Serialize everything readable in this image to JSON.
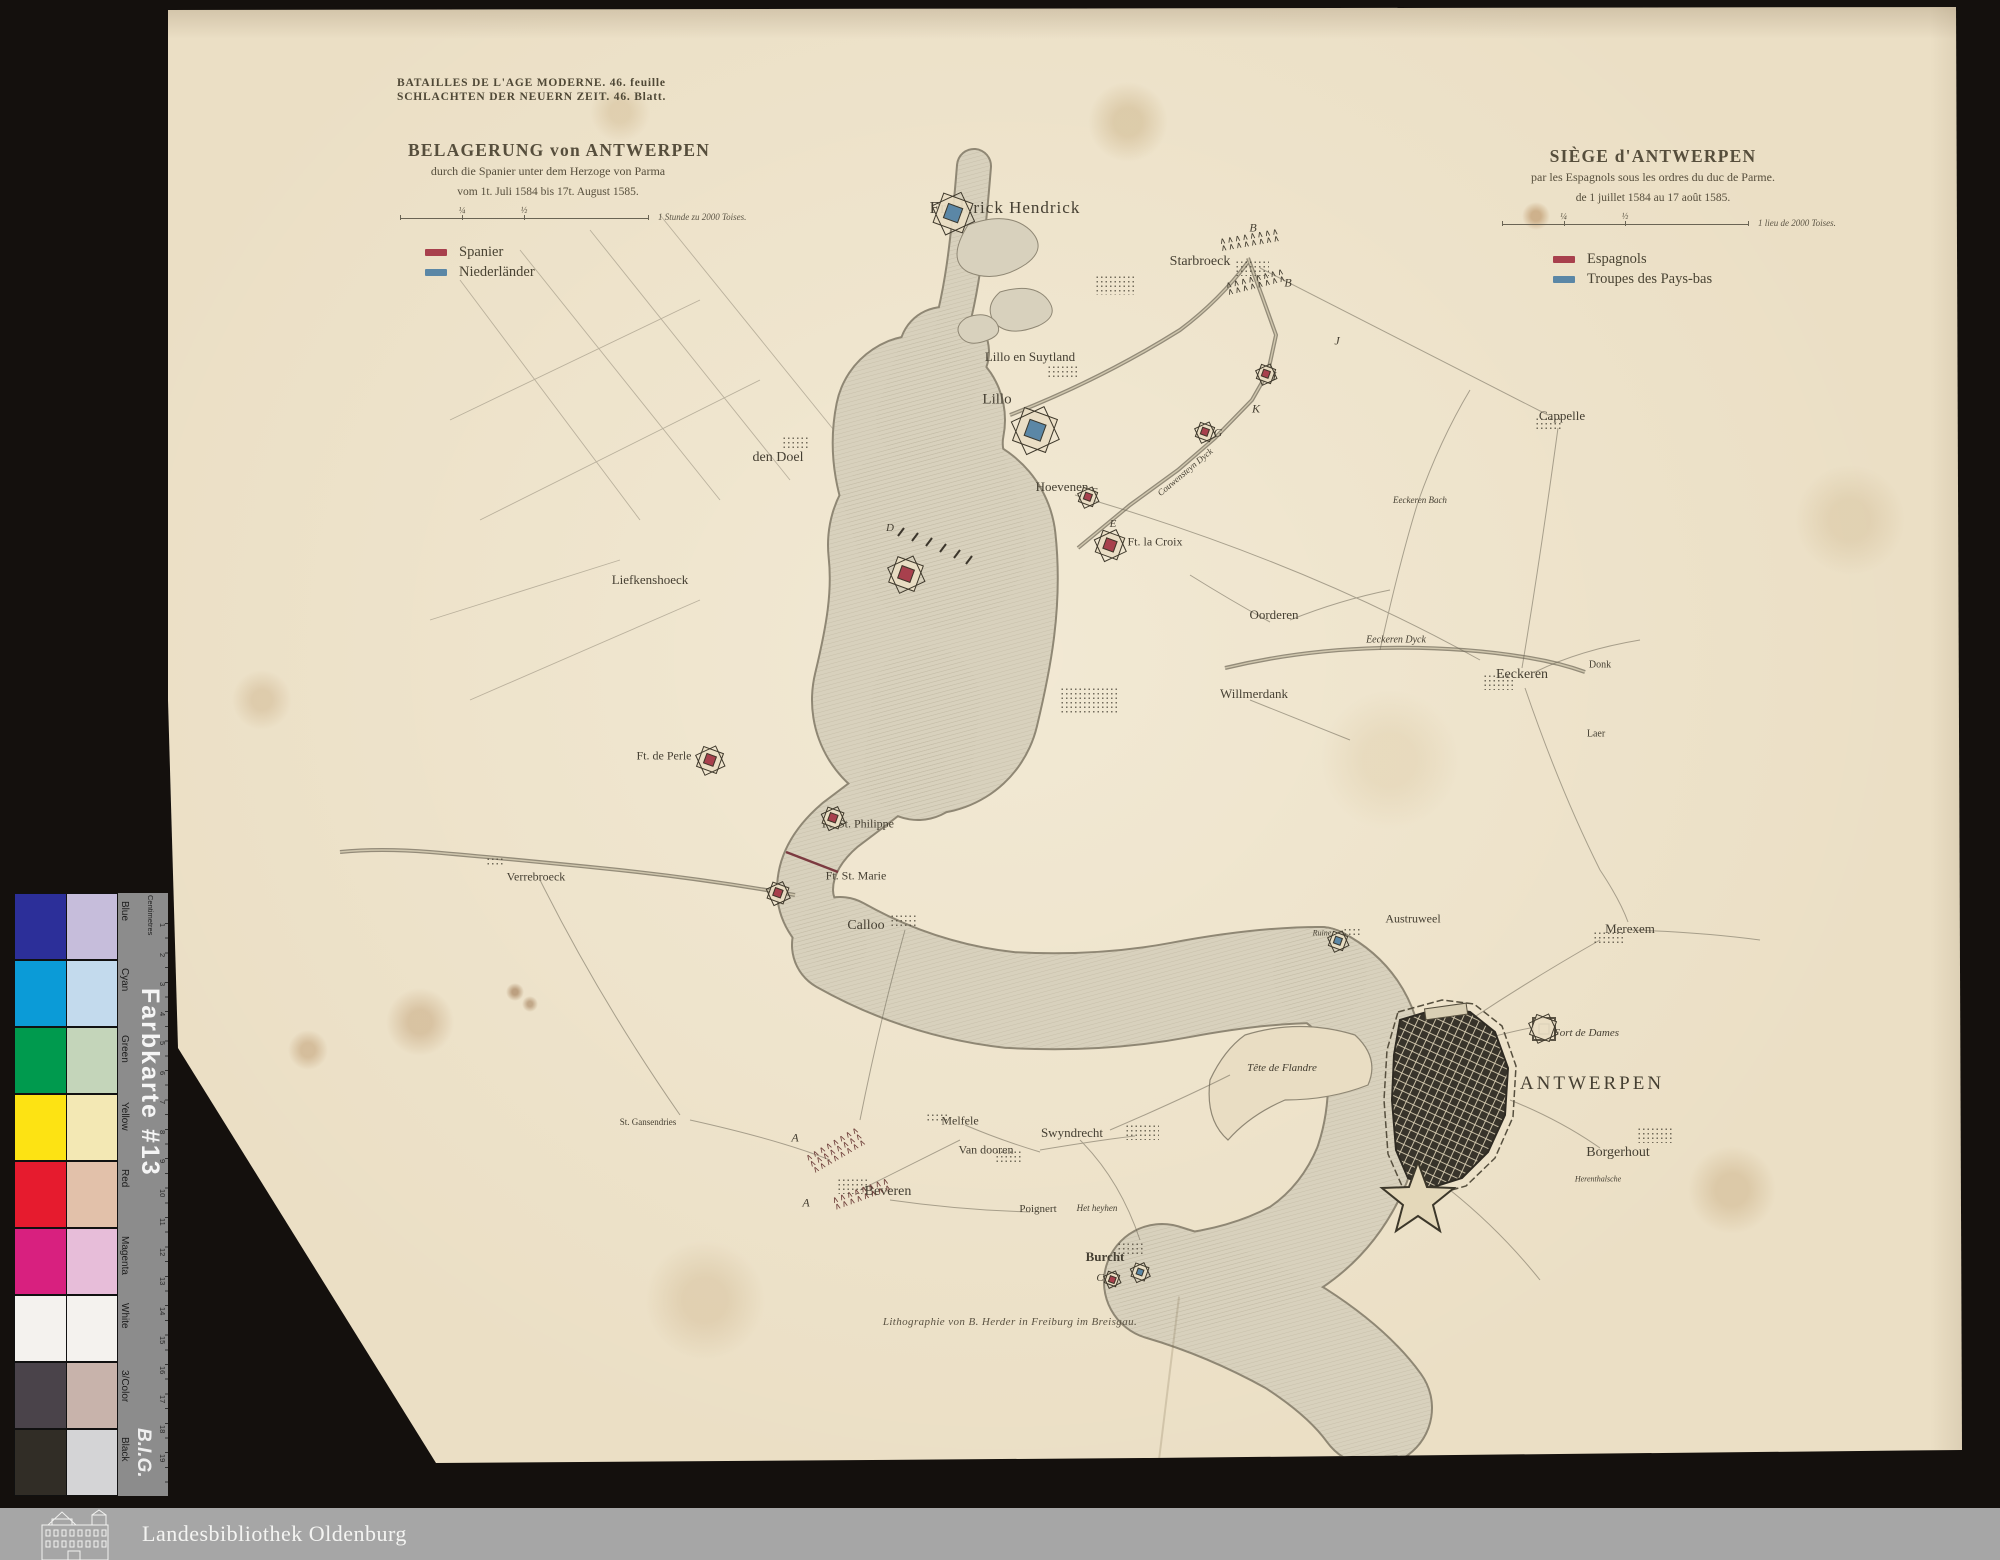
{
  "colors": {
    "spanish": "#a8404d",
    "dutch": "#5b87a6",
    "paper": "#ebdfc5",
    "ink": "#453f32"
  },
  "header": {
    "series_fr": "BATAILLES DE L'AGE MODERNE. 46. feuille",
    "series_de": "SCHLACHTEN DER NEUERN ZEIT. 46. Blatt.",
    "title_de": {
      "line1": "BELAGERUNG von ANTWERPEN",
      "line2": "durch die Spanier unter dem Herzoge von Parma",
      "line3": "vom 1t. Juli 1584 bis 17t. August 1585."
    },
    "title_fr": {
      "line1": "SIÈGE d'ANTWERPEN",
      "line2": "par les Espagnols sous les ordres du duc de Parme.",
      "line3": "de 1 juillet 1584 au 17 août 1585."
    },
    "scale_de": {
      "quarter": "¼",
      "half": "½",
      "label": "1 Stunde zu 2000 Toises."
    },
    "scale_fr": {
      "quarter": "¼",
      "half": "½",
      "label": "1 lieu de 2000 Toises."
    }
  },
  "legend_de": {
    "items": [
      {
        "label": "Spanier"
      },
      {
        "label": "Niederländer"
      }
    ]
  },
  "legend_fr": {
    "items": [
      {
        "label": "Espagnols"
      },
      {
        "label": "Troupes des Pays-bas"
      }
    ]
  },
  "map": {
    "imprint": "Lithographie von B. Herder in Freiburg im Breisgau.",
    "labels": [
      {
        "t": "Frederick Hendrick",
        "x": 1005,
        "y": 208,
        "s": 17,
        "ls": 1
      },
      {
        "t": "Starbroeck",
        "x": 1200,
        "y": 262,
        "s": 14
      },
      {
        "t": "Lillo en Suytland",
        "x": 1030,
        "y": 357,
        "s": 13
      },
      {
        "t": "Lillo",
        "x": 997,
        "y": 400,
        "s": 15
      },
      {
        "t": "Cappelle",
        "x": 1562,
        "y": 416,
        "s": 13
      },
      {
        "t": "den Doel",
        "x": 778,
        "y": 458,
        "s": 14
      },
      {
        "t": "Hoevenen",
        "x": 1062,
        "y": 487,
        "s": 13
      },
      {
        "t": "Ft. la Croix",
        "x": 1155,
        "y": 542,
        "s": 12
      },
      {
        "t": "Liefkenshoeck",
        "x": 650,
        "y": 580,
        "s": 13
      },
      {
        "t": "Couwensteyn Dyck",
        "x": 1185,
        "y": 472,
        "s": 9,
        "i": 1,
        "r": -40
      },
      {
        "t": "Eeckeren Bach",
        "x": 1420,
        "y": 500,
        "s": 9,
        "i": 1
      },
      {
        "t": "Oorderen",
        "x": 1274,
        "y": 615,
        "s": 13
      },
      {
        "t": "Eeckeren Dyck",
        "x": 1396,
        "y": 640,
        "s": 10,
        "i": 1
      },
      {
        "t": "Eeckeren",
        "x": 1522,
        "y": 675,
        "s": 14
      },
      {
        "t": "Donk",
        "x": 1600,
        "y": 665,
        "s": 10
      },
      {
        "t": "Willmerdank",
        "x": 1254,
        "y": 694,
        "s": 13
      },
      {
        "t": "Laer",
        "x": 1596,
        "y": 734,
        "s": 10
      },
      {
        "t": "Ft. de Perle",
        "x": 664,
        "y": 756,
        "s": 12
      },
      {
        "t": "Ft. St. Philippe",
        "x": 858,
        "y": 824,
        "s": 12
      },
      {
        "t": "Verrebroeck",
        "x": 536,
        "y": 877,
        "s": 12
      },
      {
        "t": "Ft. St. Marie",
        "x": 856,
        "y": 876,
        "s": 12
      },
      {
        "t": "Calloo",
        "x": 866,
        "y": 926,
        "s": 14
      },
      {
        "t": "Austruweel",
        "x": 1413,
        "y": 919,
        "s": 12
      },
      {
        "t": "Ruine",
        "x": 1322,
        "y": 933,
        "s": 8,
        "i": 1
      },
      {
        "t": "Merexem",
        "x": 1630,
        "y": 929,
        "s": 13
      },
      {
        "t": "Fort de Dames",
        "x": 1586,
        "y": 1033,
        "s": 11,
        "i": 1
      },
      {
        "t": "ANTWERPEN",
        "x": 1592,
        "y": 1084,
        "s": 19,
        "ls": 3
      },
      {
        "t": "Tête de Flandre",
        "x": 1282,
        "y": 1068,
        "s": 11,
        "i": 1
      },
      {
        "t": "Borgerhout",
        "x": 1618,
        "y": 1153,
        "s": 14
      },
      {
        "t": "Herenthalsche",
        "x": 1598,
        "y": 1179,
        "s": 8,
        "i": 1
      },
      {
        "t": "St. Gansendries",
        "x": 648,
        "y": 1122,
        "s": 9
      },
      {
        "t": "Melfele",
        "x": 960,
        "y": 1121,
        "s": 12
      },
      {
        "t": "Swyndrecht",
        "x": 1072,
        "y": 1133,
        "s": 13
      },
      {
        "t": "Van dooren",
        "x": 986,
        "y": 1150,
        "s": 12
      },
      {
        "t": "Beveren",
        "x": 888,
        "y": 1192,
        "s": 14
      },
      {
        "t": "Poignert",
        "x": 1038,
        "y": 1209,
        "s": 11
      },
      {
        "t": "Het heyhen",
        "x": 1097,
        "y": 1208,
        "s": 9,
        "i": 1
      },
      {
        "t": "Burcht",
        "x": 1105,
        "y": 1257,
        "s": 13,
        "b": 1
      },
      {
        "t": "B",
        "x": 1253,
        "y": 228,
        "s": 12,
        "i": 1
      },
      {
        "t": "B",
        "x": 1288,
        "y": 283,
        "s": 12,
        "i": 1
      },
      {
        "t": "J",
        "x": 1337,
        "y": 341,
        "s": 12,
        "i": 1
      },
      {
        "t": "H",
        "x": 1272,
        "y": 376,
        "s": 12,
        "i": 1
      },
      {
        "t": "K",
        "x": 1256,
        "y": 409,
        "s": 12,
        "i": 1
      },
      {
        "t": "G",
        "x": 1218,
        "y": 433,
        "s": 12,
        "i": 1
      },
      {
        "t": "F",
        "x": 1094,
        "y": 492,
        "s": 11,
        "i": 1
      },
      {
        "t": "E",
        "x": 1113,
        "y": 524,
        "s": 11,
        "i": 1
      },
      {
        "t": "D",
        "x": 890,
        "y": 528,
        "s": 11,
        "i": 1
      },
      {
        "t": "A",
        "x": 795,
        "y": 1138,
        "s": 12,
        "i": 1
      },
      {
        "t": "A",
        "x": 806,
        "y": 1203,
        "s": 12,
        "i": 1
      },
      {
        "t": "C",
        "x": 1100,
        "y": 1278,
        "s": 11,
        "i": 1
      }
    ],
    "forts": [
      {
        "x": 953,
        "y": 213,
        "c": "blue",
        "s": 30
      },
      {
        "x": 1035,
        "y": 430,
        "c": "blue",
        "s": 34
      },
      {
        "x": 906,
        "y": 574,
        "c": "red",
        "s": 26
      },
      {
        "x": 710,
        "y": 760,
        "c": "red",
        "s": 20
      },
      {
        "x": 1110,
        "y": 545,
        "c": "red",
        "s": 22
      },
      {
        "x": 1088,
        "y": 497,
        "c": "red",
        "s": 14
      },
      {
        "x": 1205,
        "y": 432,
        "c": "red",
        "s": 14
      },
      {
        "x": 1266,
        "y": 374,
        "c": "red",
        "s": 14
      },
      {
        "x": 833,
        "y": 818,
        "c": "red",
        "s": 16
      },
      {
        "x": 778,
        "y": 893,
        "c": "red",
        "s": 16
      },
      {
        "x": 1338,
        "y": 941,
        "c": "blue",
        "s": 14
      },
      {
        "x": 1112,
        "y": 1279,
        "c": "red",
        "s": 11
      },
      {
        "x": 1140,
        "y": 1272,
        "c": "blue",
        "s": 13
      },
      {
        "x": 1543,
        "y": 1028,
        "c": "none",
        "s": 20
      }
    ],
    "camps": [
      {
        "x": 1250,
        "y": 240,
        "rot": -10,
        "rows": 2,
        "col": "#433d30"
      },
      {
        "x": 1256,
        "y": 282,
        "rot": -14,
        "rows": 2,
        "col": "#433d30"
      },
      {
        "x": 836,
        "y": 1150,
        "rot": -30,
        "rows": 3,
        "col": "#70413c"
      },
      {
        "x": 862,
        "y": 1194,
        "rot": -20,
        "rows": 2,
        "col": "#70413c"
      }
    ],
    "dots": [
      {
        "x": 1252,
        "y": 268,
        "w": 34,
        "h": 16
      },
      {
        "x": 1548,
        "y": 424,
        "w": 26,
        "h": 14
      },
      {
        "x": 1115,
        "y": 285,
        "w": 40,
        "h": 20
      },
      {
        "x": 1062,
        "y": 372,
        "w": 30,
        "h": 14
      },
      {
        "x": 795,
        "y": 442,
        "w": 26,
        "h": 12
      },
      {
        "x": 1498,
        "y": 682,
        "w": 30,
        "h": 16
      },
      {
        "x": 1608,
        "y": 938,
        "w": 30,
        "h": 14
      },
      {
        "x": 1090,
        "y": 700,
        "w": 60,
        "h": 26
      },
      {
        "x": 903,
        "y": 920,
        "w": 26,
        "h": 12
      },
      {
        "x": 1142,
        "y": 1132,
        "w": 34,
        "h": 16
      },
      {
        "x": 937,
        "y": 1118,
        "w": 22,
        "h": 10
      },
      {
        "x": 1008,
        "y": 1156,
        "w": 26,
        "h": 12
      },
      {
        "x": 852,
        "y": 1186,
        "w": 30,
        "h": 16
      },
      {
        "x": 495,
        "y": 862,
        "w": 18,
        "h": 10
      },
      {
        "x": 1130,
        "y": 1248,
        "w": 26,
        "h": 12
      },
      {
        "x": 1352,
        "y": 932,
        "w": 18,
        "h": 9
      },
      {
        "x": 1655,
        "y": 1135,
        "w": 36,
        "h": 16
      }
    ]
  },
  "color_card": {
    "title": "Farbkarte #13",
    "brand": "B.I.G.",
    "ruler_label": "Centimetres",
    "ruler_numbers": [
      "1",
      "2",
      "3",
      "4",
      "5",
      "6",
      "7",
      "8",
      "9",
      "10",
      "11",
      "12",
      "13",
      "14",
      "15",
      "16",
      "17",
      "18",
      "19"
    ],
    "rows": [
      {
        "label": "Blue",
        "solid": "#2c2f99",
        "tint": "#c6bddb"
      },
      {
        "label": "Cyan",
        "solid": "#0b9bd7",
        "tint": "#c3daed"
      },
      {
        "label": "Green",
        "solid": "#009a4e",
        "tint": "#c4d5ba"
      },
      {
        "label": "Yellow",
        "solid": "#fde313",
        "tint": "#f3e8b4"
      },
      {
        "label": "Red",
        "solid": "#e61b2e",
        "tint": "#e2c1aa"
      },
      {
        "label": "Magenta",
        "solid": "#d8207f",
        "tint": "#e7bdd9"
      },
      {
        "label": "White",
        "solid": "#f4f2ee",
        "tint": "#f4f2ee"
      },
      {
        "label": "3/Color",
        "solid": "#4a434a",
        "tint": "#c8b3ab"
      },
      {
        "label": "Black",
        "solid": "#312d26",
        "tint": "#d4d4d6"
      }
    ]
  },
  "footer": {
    "library": "Landesbibliothek Oldenburg"
  }
}
